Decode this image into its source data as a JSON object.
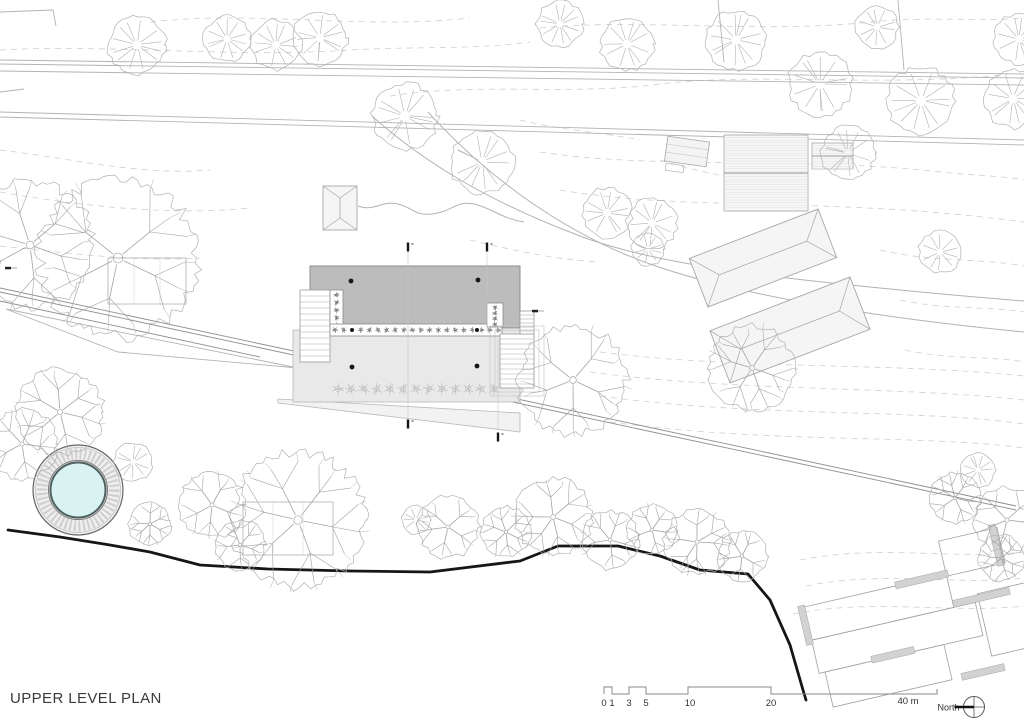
{
  "meta": {
    "title": "UPPER LEVEL PLAN"
  },
  "scalebar": {
    "baseline_y": 694,
    "raised_y": 687,
    "x_start": 604,
    "x_end": 937,
    "raised": [
      [
        604,
        612
      ],
      [
        629,
        646
      ],
      [
        688,
        771
      ]
    ],
    "ticks": [
      {
        "label": "0",
        "x": 604
      },
      {
        "label": "1",
        "x": 612
      },
      {
        "label": "3",
        "x": 629
      },
      {
        "label": "5",
        "x": 646
      },
      {
        "label": "10",
        "x": 690
      },
      {
        "label": "20",
        "x": 771
      }
    ],
    "end_label": "40 m",
    "end_label_x": 908,
    "north": {
      "label": "North",
      "cx": 974,
      "cy": 707,
      "r": 10.5
    }
  },
  "plan": {
    "colors": {
      "ink": "#161616",
      "line_dark": "#8f8f8f",
      "line": "#b3b3b3",
      "contour": "#cfcfcf",
      "tree": "#b2b2b2",
      "tree_dark": "#a3a3a3",
      "plant": "#6b6b6b",
      "plant_light": "#b4b4b4",
      "roof_fill": "#bcbcbc",
      "roof_stroke": "#8c8c8c",
      "terrace_fill": "#e9e9e9",
      "terrace_stroke": "#b8b8b8",
      "apron_fill": "#f2f2f2",
      "bldg_fill": "#f5f5f5",
      "bldg_stroke": "#a8a8a8",
      "water": "#d8f3f2",
      "water_rim": "#4f5f5f",
      "wall_fill": "#d2d2d2",
      "text": "#333333"
    },
    "contours": [
      "M150,22 C260,10 360,30 470,18",
      "M0,50 C110,44 230,58 350,50 C420,46 470,50 530,42",
      "M540,28 C640,18 760,34 870,22 C930,16 980,22 1024,18",
      "M390,96 C480,82 570,96 660,84 C760,72 880,88 1010,74",
      "M0,150 C70,158 140,176 210,170",
      "M0,192 C80,206 170,216 250,208",
      "M0,246 C60,252 130,262 200,258",
      "M540,152 C660,170 800,156 940,172 C980,176 1005,176 1024,180",
      "M560,190 C690,212 830,196 1024,222",
      "M470,240 C520,252 560,260 600,262",
      "M600,352 C740,370 890,362 1024,376",
      "M590,372 C740,392 900,386 1024,400",
      "M600,396 C760,418 910,408 1024,424",
      "M610,422 C770,444 920,434 1024,448",
      "M880,250 C930,262 980,258 1024,266",
      "M900,300 C945,310 990,306 1024,312",
      "M905,350 C950,360 995,356 1024,362",
      "M800,560 C880,544 950,560 1024,552",
      "M806,586 C886,570 956,586 1024,578",
      "M793,614 C873,598 953,614 1024,606",
      "M520,120 C560,130 600,132 640,140",
      "M660,160 C700,172 730,178 760,182"
    ],
    "roads": {
      "lines": [
        [
          0,
          60,
          1024,
          74
        ],
        [
          0,
          64,
          1024,
          78
        ],
        [
          0,
          71,
          1024,
          85
        ],
        [
          0,
          112,
          1024,
          140
        ],
        [
          0,
          117,
          1024,
          145
        ],
        [
          898,
          0,
          904,
          70
        ],
        [
          718,
          0,
          724,
          62
        ]
      ],
      "polylines": [
        "0,12 53,10 56,26",
        "0,92 24,89",
        "6,309 298,368 118,352 6,309"
      ],
      "curves": [
        "M372,116 C430,168 500,206 580,236 C660,266 780,278 900,290 C960,296 1000,299 1024,301",
        "M428,112 C482,172 560,232 650,264 C740,296 880,318 1024,332",
        "M358,206 C374,212 382,200 398,204 C414,208 414,216 432,214 C452,212 456,200 474,204 C492,208 500,218 524,222"
      ]
    },
    "track": [
      [
        0,
        288,
        1016,
        506
      ],
      [
        0,
        292,
        1016,
        510
      ],
      [
        0,
        301,
        260,
        357
      ]
    ],
    "boundary": "8,530 60,537 110,545 150,552 200,565 268,569 350,571 430,572 520,561 558,546 618,546 660,556 700,570 748,574 770,600 790,645 803,690 806,700",
    "pool": {
      "cx": 78,
      "cy": 490,
      "r_outer": 45,
      "r_ring": 36,
      "r_rim": 29.5,
      "r_water": 27.5
    },
    "building": {
      "roof": [
        310,
        266,
        210,
        62
      ],
      "terrace": [
        293,
        330,
        227,
        72
      ],
      "apron": "278,399 520,413 520,432 278,403",
      "stair_left": {
        "rect": [
          300,
          290,
          30,
          72
        ],
        "step": 6
      },
      "stair_right_upper": {
        "rect": [
          520,
          311,
          14,
          27
        ],
        "step": 4
      },
      "stair_right_lower": {
        "rect": [
          500,
          334,
          34,
          54
        ],
        "step": 5
      },
      "stair_right_frames": [
        [
          495,
          330,
          44,
          62
        ],
        [
          490,
          326,
          54,
          70
        ]
      ],
      "planter_left": {
        "rect": [
          330,
          290,
          13,
          38
        ],
        "n": 5
      },
      "planter_row": {
        "rect": [
          330,
          324,
          172,
          12
        ],
        "n": 20
      },
      "planter_right": {
        "rect": [
          487,
          303,
          16,
          24
        ],
        "n": 4
      },
      "plant_row2": {
        "y": 389,
        "x1": 338,
        "x2": 494,
        "n": 13,
        "r": 6
      },
      "columns_roof": [
        [
          351,
          281
        ],
        [
          478,
          280
        ]
      ],
      "columns_terrace": [
        [
          352,
          367
        ],
        [
          477,
          366
        ]
      ],
      "columns_row": [
        [
          352,
          330
        ],
        [
          477,
          330
        ]
      ],
      "sections": [
        [
          408,
          247
        ],
        [
          487,
          247
        ],
        [
          408,
          424
        ],
        [
          498,
          437
        ]
      ],
      "section_lines": [
        [
          408,
          252,
          408,
          418
        ],
        [
          487,
          252,
          487,
          330
        ],
        [
          498,
          340,
          498,
          430
        ]
      ]
    },
    "neighbors": {
      "hip_small": {
        "x": 323,
        "y": 186,
        "w": 34,
        "h": 44
      },
      "hip_buildings": [
        {
          "cx": 763,
          "cy": 258,
          "w": 138,
          "h": 52,
          "angle": -21
        },
        {
          "cx": 790,
          "cy": 330,
          "w": 150,
          "h": 56,
          "angle": -21
        }
      ],
      "hatched_main": [
        724,
        135,
        84,
        76
      ],
      "hatched_annex": [
        812,
        143,
        41,
        26
      ],
      "shed": {
        "x": 666,
        "y": 139,
        "w": 42,
        "h": 25,
        "angle": 8
      },
      "southeast": {
        "tx": 800,
        "ty": 608,
        "angle": -13,
        "rooms": [
          [
            0,
            0,
            150,
            34
          ],
          [
            4,
            34,
            168,
            34
          ],
          [
            10,
            68,
            122,
            36
          ],
          [
            176,
            26,
            140,
            64
          ],
          [
            150,
            -34,
            60,
            36
          ]
        ],
        "walls": [
          [
            98,
            -4,
            54,
            7
          ],
          [
            150,
            27,
            58,
            7
          ],
          [
            58,
            63,
            44,
            7
          ],
          [
            202,
            -38,
            7,
            42
          ],
          [
            142,
            100,
            44,
            7
          ],
          [
            -2,
            -2,
            7,
            40
          ]
        ]
      }
    },
    "trees": [
      [
        137,
        45,
        30,
        "s"
      ],
      [
        227,
        39,
        24,
        "s"
      ],
      [
        276,
        45,
        26,
        "s"
      ],
      [
        320,
        38,
        28,
        "s"
      ],
      [
        405,
        116,
        34,
        "s"
      ],
      [
        482,
        162,
        33,
        "s"
      ],
      [
        560,
        24,
        24,
        "s"
      ],
      [
        627,
        44,
        28,
        "s"
      ],
      [
        736,
        40,
        31,
        "s"
      ],
      [
        820,
        84,
        33,
        "s"
      ],
      [
        848,
        153,
        28,
        "s"
      ],
      [
        877,
        27,
        22,
        "s"
      ],
      [
        921,
        101,
        35,
        "s"
      ],
      [
        1013,
        99,
        30,
        "s"
      ],
      [
        1019,
        39,
        26,
        "s"
      ],
      [
        607,
        213,
        26,
        "s"
      ],
      [
        652,
        223,
        26,
        "s"
      ],
      [
        648,
        249,
        17,
        "s"
      ],
      [
        940,
        252,
        22,
        "s"
      ],
      [
        118,
        258,
        82,
        "b"
      ],
      [
        30,
        245,
        66,
        "b"
      ],
      [
        60,
        412,
        45,
        "b"
      ],
      [
        22,
        444,
        36,
        "b"
      ],
      [
        133,
        462,
        20,
        "s"
      ],
      [
        150,
        524,
        22,
        "b"
      ],
      [
        212,
        505,
        34,
        "b"
      ],
      [
        240,
        545,
        26,
        "b"
      ],
      [
        298,
        520,
        70,
        "b"
      ],
      [
        416,
        520,
        15,
        "s"
      ],
      [
        448,
        527,
        32,
        "b"
      ],
      [
        506,
        532,
        26,
        "b"
      ],
      [
        553,
        517,
        40,
        "b"
      ],
      [
        610,
        540,
        30,
        "b"
      ],
      [
        652,
        530,
        26,
        "b"
      ],
      [
        697,
        542,
        34,
        "b"
      ],
      [
        742,
        556,
        26,
        "b"
      ],
      [
        573,
        380,
        56,
        "b"
      ],
      [
        752,
        368,
        44,
        "b"
      ],
      [
        955,
        498,
        26,
        "b"
      ],
      [
        1007,
        520,
        34,
        "b"
      ],
      [
        978,
        470,
        18,
        "s"
      ],
      [
        1002,
        558,
        24,
        "b"
      ]
    ],
    "tree_frames": [
      [
        243,
        502,
        90,
        53
      ],
      [
        108,
        258,
        78,
        46
      ]
    ],
    "benchmarks": [
      [
        535,
        311
      ],
      [
        8,
        268
      ]
    ]
  }
}
